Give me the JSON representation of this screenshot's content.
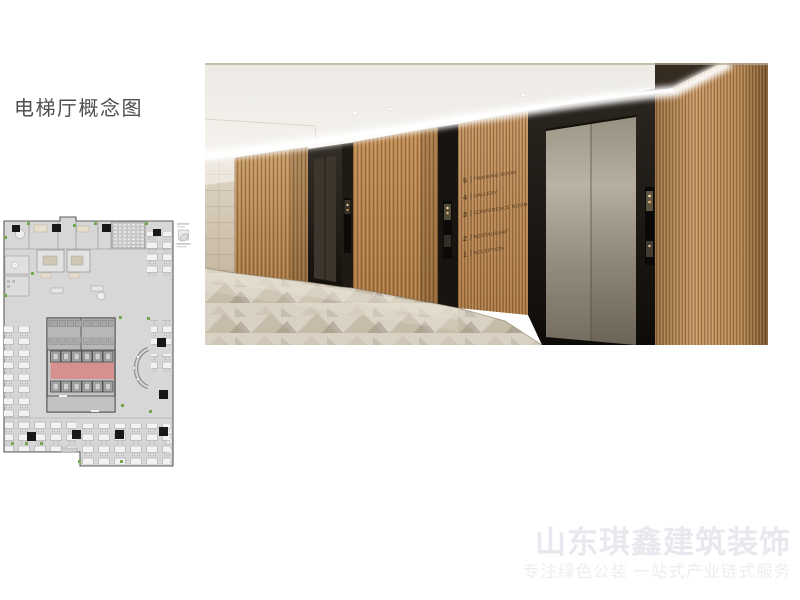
{
  "slide": {
    "background": "#ffffff"
  },
  "title": {
    "text": "电梯厅概念图",
    "color": "#4f4f4f"
  },
  "floorplan": {
    "highlight_color": "#d98b8b",
    "floor_color": "#d7d7d7",
    "plant_color": "#6fa84e"
  },
  "photo": {
    "directory": {
      "text_color": "#3e2d1a",
      "items": [
        {
          "floor": "5",
          "label": "TRAINING ROOM"
        },
        {
          "floor": "4",
          "label": "GALLERY"
        },
        {
          "floor": "3",
          "label": "CONFERENCE ROOM"
        },
        {
          "floor": "2",
          "label": "RESTAURANT"
        },
        {
          "floor": "1",
          "label": "RECEPTION"
        }
      ]
    }
  },
  "watermark": {
    "line1": "山东琪鑫建筑装饰",
    "line2": "专注绿色公装  一站式产业链式服务",
    "color": "#e8e9ee"
  }
}
